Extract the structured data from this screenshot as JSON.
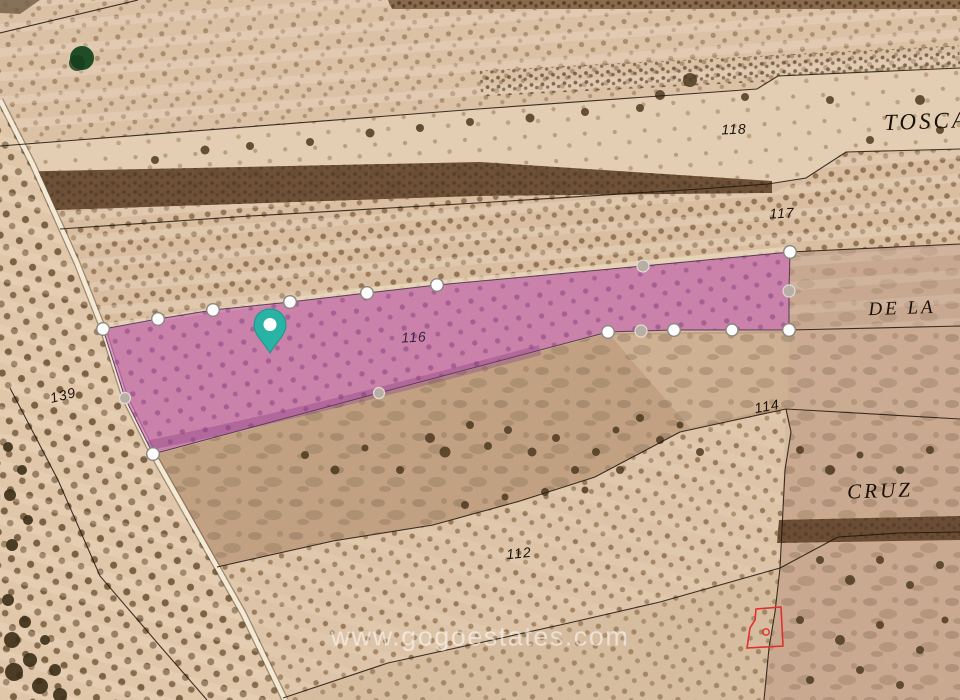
{
  "labels": {
    "parcel_118": "118",
    "parcel_117": "117",
    "parcel_116": "116",
    "parcel_114": "114",
    "parcel_139": "139",
    "parcel_112": "112",
    "place_toscar": "TOSCARE",
    "place_de_la": "DE LA",
    "place_cruz": "CRUZ"
  },
  "watermark": "www.gogoestates.com",
  "colors": {
    "parcel_highlight": "#bf4fb4",
    "pin": "#29b3a5",
    "red_outline": "#e03131"
  }
}
